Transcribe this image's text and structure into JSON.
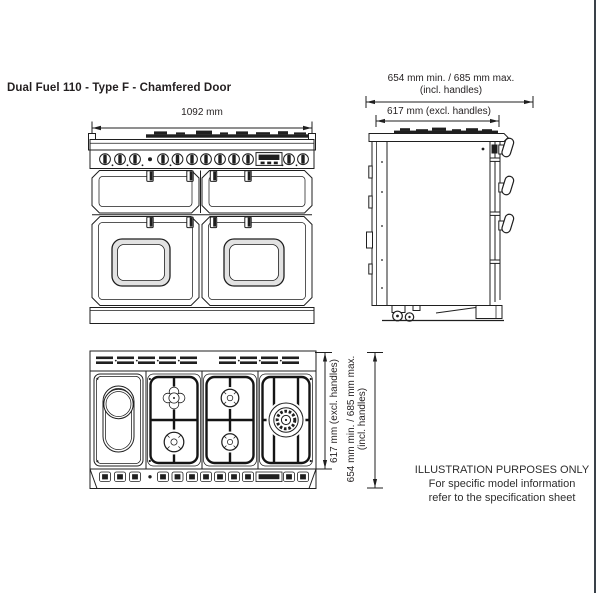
{
  "page": {
    "title": "Dual Fuel 110 - Type F - Chamfered Door",
    "ink_color": "#231f20",
    "page_edge_color": "#3a4149"
  },
  "front_view": {
    "width_dim": "1092 mm"
  },
  "side_view": {
    "depth_incl_dim": "654 mm min. / 685 mm max.",
    "depth_incl_note": "(incl. handles)",
    "depth_excl_dim": "617 mm (excl. handles)"
  },
  "plan_view": {
    "depth_excl_dim": "617 mm (excl. handles)",
    "depth_incl_dim": "654 mm min. / 685 mm max.",
    "depth_incl_note": "(incl. handles)"
  },
  "disclaimer": {
    "line1": "ILLUSTRATION PURPOSES ONLY",
    "line2": "For specific model information",
    "line3": "refer to the specification sheet"
  }
}
